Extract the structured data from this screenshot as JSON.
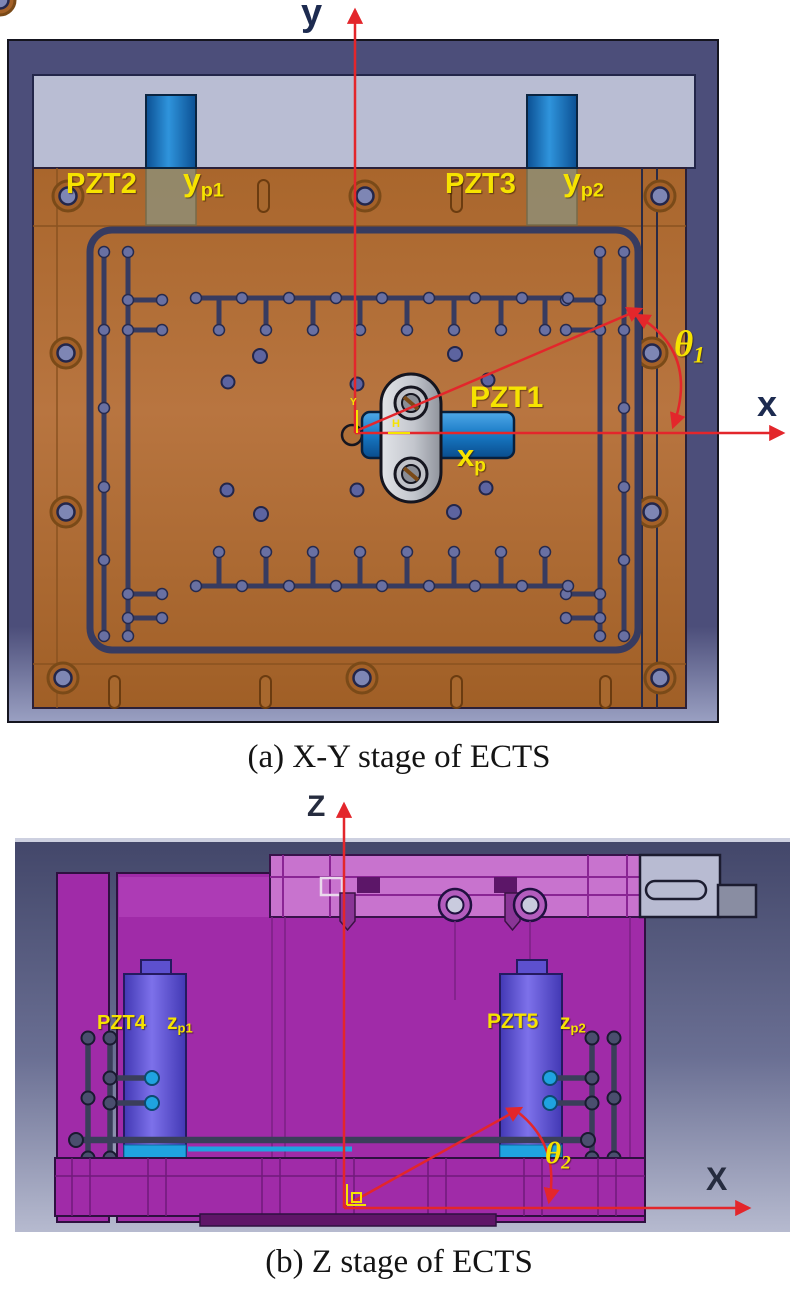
{
  "colors": {
    "label_yellow": "#f6e300",
    "axis_red": "#e3262b",
    "copper_body": "#b06a33",
    "slot_navy": "#373b60",
    "frame_navy": "#4c4e7a",
    "lavender_panel": "#b9bdd3",
    "magenta_body": "#a02ba8",
    "pzt_blue": "#1779c4",
    "pzt_violet": "#6a5ee0",
    "cyan_accent": "#1fa3e0"
  },
  "figure_a": {
    "caption": "(a) X-Y stage of ECTS",
    "axis_y": "y",
    "axis_x": "x",
    "theta": "θ",
    "theta_sub": "1",
    "labels": {
      "pzt1": "PZT1",
      "pzt2": "PZT2",
      "pzt3": "PZT3",
      "xp_base": "x",
      "xp_sub": "p",
      "yp1_base": "y",
      "yp1_sub": "p1",
      "yp2_base": "y",
      "yp2_sub": "p2"
    },
    "origin_marks": {
      "v": "Y",
      "h": "H"
    }
  },
  "figure_b": {
    "caption": "(b) Z stage of ECTS",
    "axis_z": "Z",
    "axis_x": "X",
    "theta": "θ",
    "theta_sub": "2",
    "labels": {
      "pzt4": "PZT4",
      "pzt5": "PZT5",
      "zp1_base": "z",
      "zp1_sub": "p1",
      "zp2_base": "z",
      "zp2_sub": "p2"
    }
  }
}
